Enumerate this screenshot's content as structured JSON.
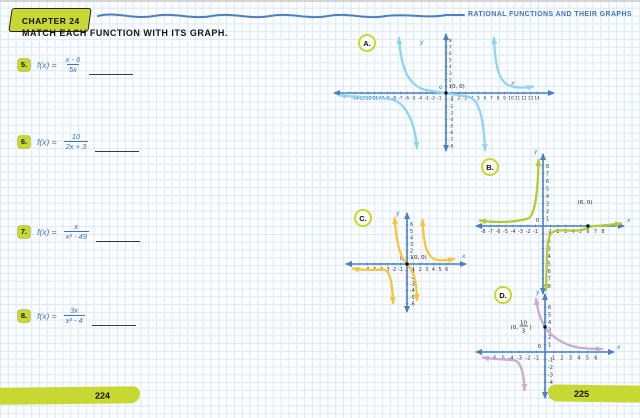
{
  "header": {
    "chapter_tab": "CHAPTER 24",
    "page_title": "RATIONAL FUNCTIONS AND THEIR GRAPHS",
    "instruction": "MATCH EACH FUNCTION WITH ITS GRAPH."
  },
  "problems": [
    {
      "number": "5.",
      "fname": "f(x) =",
      "numerator": "x - 6",
      "denominator": "5x"
    },
    {
      "number": "6.",
      "fname": "f(x) =",
      "numerator": "10",
      "denominator": "2x + 3"
    },
    {
      "number": "7.",
      "fname": "f(x) =",
      "numerator": "x",
      "denominator": "x² - 49"
    },
    {
      "number": "8.",
      "fname": "f(x) =",
      "numerator": "3x",
      "denominator": "x² - 4"
    }
  ],
  "page_numbers": {
    "left": "224",
    "right": "225"
  },
  "colors": {
    "axis": "#4a7fc1",
    "ink": "#3f74bd",
    "accent_green": "#c8d832",
    "tick_text": "#26334d"
  },
  "graphs": {
    "A": {
      "label": "A.",
      "color": "#8ed5ee",
      "axis_color": "#4a7fc1",
      "tick_color": "#26334d",
      "x_label": "x",
      "y_label": "y",
      "origin_label": "0",
      "point_label": "(0, 0)",
      "x_ticks": [
        -14,
        -13,
        -12,
        -11,
        -10,
        -9,
        -8,
        -7,
        -6,
        -5,
        -4,
        -3,
        -2,
        -1,
        1,
        2,
        3,
        4,
        5,
        6,
        7,
        8,
        9,
        10,
        11,
        12,
        13,
        14
      ],
      "y_ticks": [
        8,
        7,
        6,
        5,
        4,
        3,
        2,
        1,
        -1,
        -2,
        -3,
        -4,
        -5,
        -6,
        -7,
        -8
      ]
    },
    "B": {
      "label": "B.",
      "color": "#b5cb33",
      "axis_color": "#4a7fc1",
      "tick_color": "#26334d",
      "x_label": "x",
      "y_label": "y",
      "origin_label": "0",
      "point_label": "(6, 0)",
      "x_ticks": [
        -8,
        -7,
        -6,
        -5,
        -4,
        -3,
        -2,
        -1,
        1,
        2,
        3,
        4,
        5,
        6,
        7,
        8
      ],
      "y_ticks": [
        8,
        7,
        6,
        5,
        4,
        3,
        2,
        1,
        -1,
        -2,
        -3,
        -4,
        -5,
        -6,
        -7,
        -8
      ]
    },
    "C": {
      "label": "C.",
      "color": "#f4c63d",
      "axis_color": "#4a7fc1",
      "tick_color": "#26334d",
      "x_label": "x",
      "y_label": "y",
      "origin_label": "0",
      "point_label": "(0, 0)",
      "x_ticks": [
        -6,
        -5,
        -4,
        -3,
        -2,
        -1,
        1,
        2,
        3,
        4,
        5,
        6
      ],
      "y_ticks": [
        6,
        5,
        4,
        3,
        2,
        1,
        -1,
        -2,
        -3,
        -4,
        -5,
        -6
      ]
    },
    "D": {
      "label": "D.",
      "color": "#c9abd6",
      "axis_color": "#4a7fc1",
      "tick_color": "#26334d",
      "x_label": "x",
      "y_label": "y",
      "origin_label": "0",
      "point_label_pre": "(0,",
      "point_label_num": "10",
      "point_label_den": "3",
      "point_label_post": ")",
      "x_ticks": [
        -6,
        -5,
        -4,
        -3,
        -2,
        -1,
        1,
        2,
        3,
        4,
        5,
        6
      ],
      "y_ticks": [
        6,
        5,
        4,
        3,
        2,
        1,
        -1,
        -2,
        -3,
        -4,
        -5,
        -6
      ]
    }
  },
  "chart_data": [
    {
      "id": "A",
      "type": "line",
      "title": "Graph A",
      "x_range": [
        -14,
        14
      ],
      "y_range": [
        -8,
        8
      ],
      "tick_step": 1,
      "vertical_asymptotes": [
        -7,
        7
      ],
      "horizontal_asymptote": 0,
      "marked_points": [
        {
          "x": 0,
          "y": 0,
          "label": "(0, 0)"
        }
      ],
      "description": "Three-branch rational curve passing through (0, 0); left branch hugs y = 0 and falls near x = -7, middle branch rises near x = -7, crosses origin, falls near x = 7, right branch rises near x = 7 then hugs y = 0."
    },
    {
      "id": "B",
      "type": "line",
      "title": "Graph B",
      "x_range": [
        -8,
        8
      ],
      "y_range": [
        -8,
        8
      ],
      "tick_step": 1,
      "vertical_asymptotes": [
        0
      ],
      "horizontal_asymptote": 0,
      "marked_points": [
        {
          "x": 6,
          "y": 0,
          "label": "(6, 0)"
        }
      ],
      "description": "Two-branch rational curve; left branch hugs just above y = 0 and rises near x = 0, right branch comes from below near x = 0 and levels off crossing the x-axis at (6, 0)."
    },
    {
      "id": "C",
      "type": "line",
      "title": "Graph C",
      "x_range": [
        -6,
        6
      ],
      "y_range": [
        -6,
        6
      ],
      "tick_step": 1,
      "vertical_asymptotes": [
        -2,
        2
      ],
      "horizontal_asymptote": 0,
      "marked_points": [
        {
          "x": 0,
          "y": 0,
          "label": "(0, 0)"
        }
      ],
      "description": "Three-branch rational curve through (0, 0) with vertical asymptotes near x = -2 and x = 2."
    },
    {
      "id": "D",
      "type": "line",
      "title": "Graph D",
      "x_range": [
        -6,
        6
      ],
      "y_range": [
        -6,
        6
      ],
      "tick_step": 1,
      "vertical_asymptotes": [
        -1.5
      ],
      "horizontal_asymptote": 0,
      "marked_points": [
        {
          "x": 0,
          "y": 3.33,
          "label": "(0, 10/3)"
        }
      ],
      "description": "Two-branch rational curve; right branch falls from top through (0, 10/3) and levels toward y = 0, left branch hugs below y = 0 and plunges near x = -2."
    }
  ]
}
